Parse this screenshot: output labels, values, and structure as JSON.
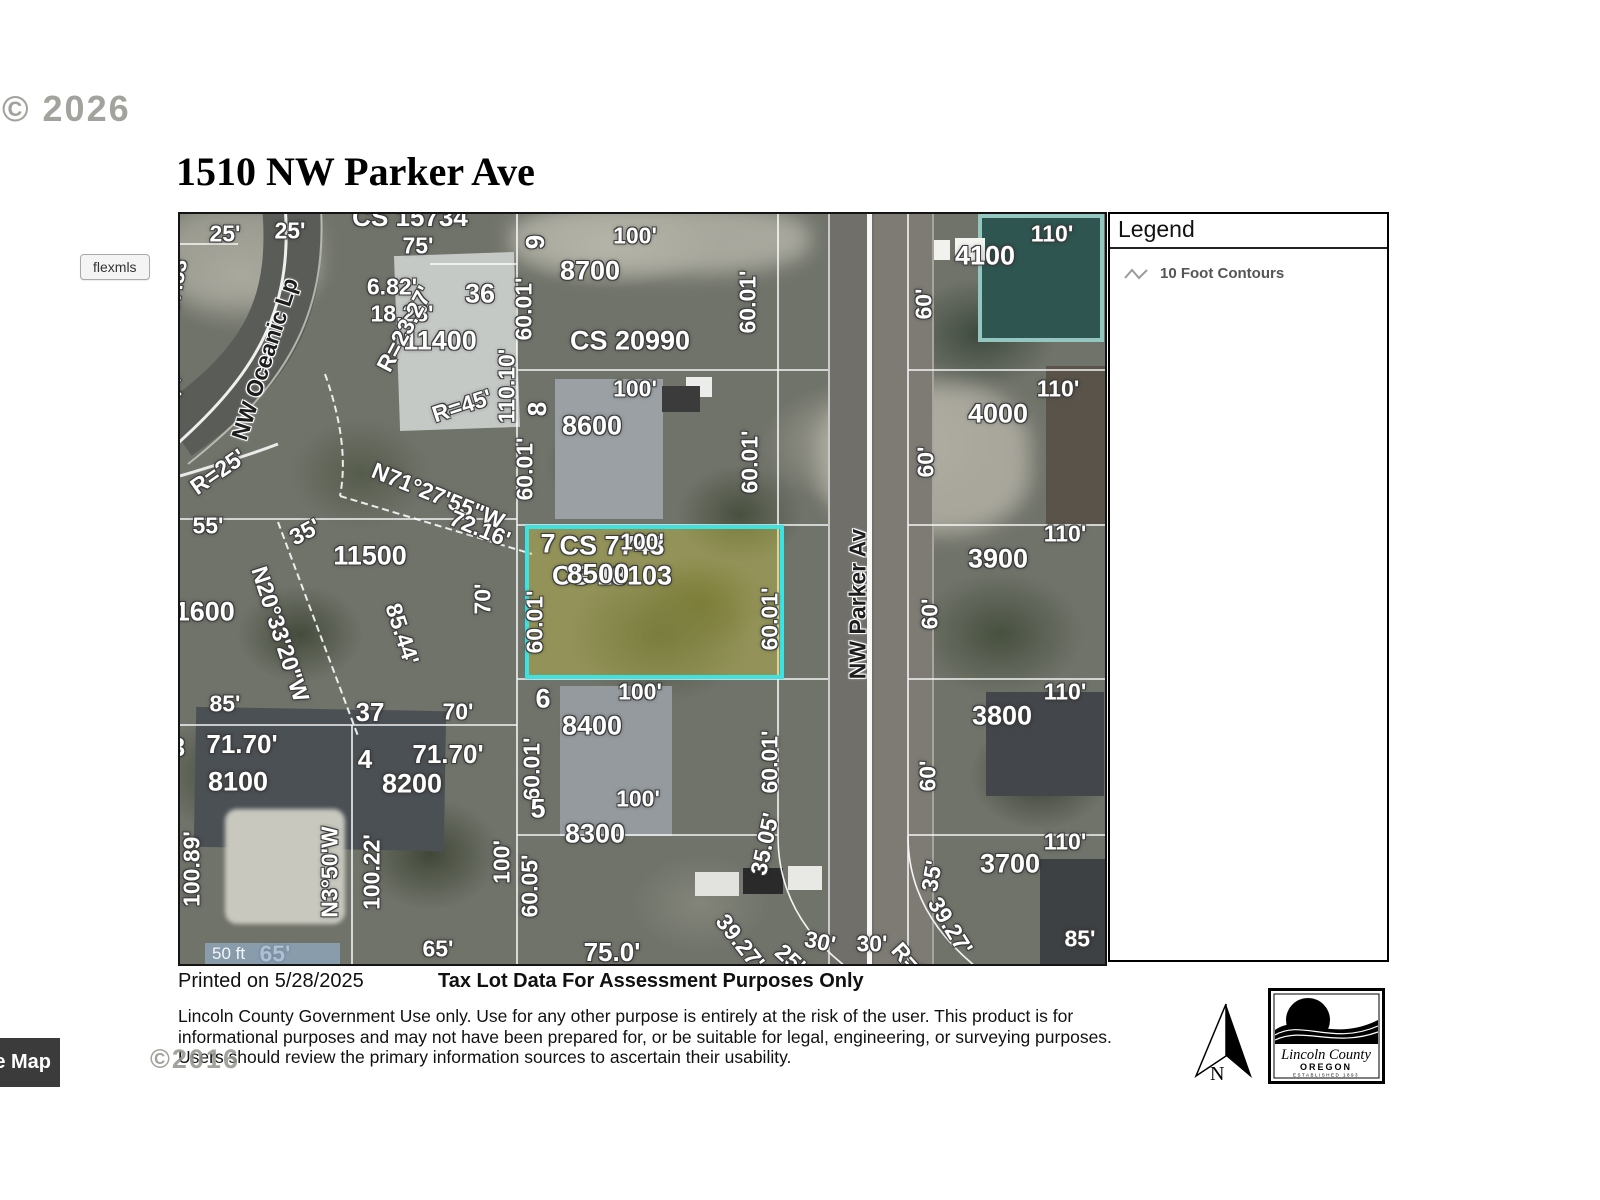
{
  "watermarks": {
    "top": "© 2026",
    "bottom": "©2016"
  },
  "header": {
    "title": "1510 NW Parker Ave"
  },
  "flexmls_button": {
    "label": "flexmls"
  },
  "legend": {
    "title": "Legend",
    "items": [
      {
        "icon": "contour-line-icon",
        "label": "10 Foot Contours"
      }
    ]
  },
  "map": {
    "scale_bar": "50 ft",
    "highlight": {
      "lot": "8500",
      "border_color": "#3be3e3",
      "fill_color": "rgba(213,206,56,0.35)"
    },
    "labels": [
      {
        "t": "25'",
        "x": 45,
        "y": 20
      },
      {
        "t": "25'",
        "x": 110,
        "y": 17
      },
      {
        "t": "CS 15734",
        "x": 230,
        "y": 3,
        "s": 26
      },
      {
        "t": "75'",
        "x": 238,
        "y": 32
      },
      {
        "t": "9",
        "x": 355,
        "y": 28,
        "r": -90,
        "s": 26
      },
      {
        "t": "100'",
        "x": 455,
        "y": 22
      },
      {
        "t": "60.01'",
        "x": 344,
        "y": 95,
        "r": -90
      },
      {
        "t": "8700",
        "x": 410,
        "y": 57,
        "s": 27
      },
      {
        "t": "60.01'",
        "x": 568,
        "y": 88,
        "r": -90
      },
      {
        "t": "110'",
        "x": 872,
        "y": 20
      },
      {
        "t": "4100",
        "x": 805,
        "y": 42,
        "s": 27
      },
      {
        "t": "60'",
        "x": 744,
        "y": 90,
        "r": -90
      },
      {
        "t": "6.82'",
        "x": 212,
        "y": 73
      },
      {
        "t": "36",
        "x": 300,
        "y": 80,
        "s": 27
      },
      {
        "t": "18.28'",
        "x": 222,
        "y": 100
      },
      {
        "t": "11400",
        "x": 260,
        "y": 127,
        "s": 27
      },
      {
        "t": "110.10'",
        "x": 327,
        "y": 172,
        "r": -90
      },
      {
        "t": "R=23.27'",
        "x": 225,
        "y": 115,
        "r": -62
      },
      {
        "t": "R=45'",
        "x": 282,
        "y": 192,
        "r": -18
      },
      {
        "t": "57.53'",
        "x": -4,
        "y": 70,
        "r": -80,
        "s": 22
      },
      {
        "t": "27'",
        "x": -6,
        "y": 178,
        "r": -48,
        "s": 22
      },
      {
        "t": "R=25'",
        "x": 38,
        "y": 258,
        "r": -35
      },
      {
        "t": "NW Oceanic Lp",
        "x": 85,
        "y": 145,
        "r": -72,
        "street": true
      },
      {
        "t": "CS 20990",
        "x": 450,
        "y": 127,
        "s": 27
      },
      {
        "t": "8",
        "x": 357,
        "y": 195,
        "r": -90,
        "s": 26
      },
      {
        "t": "100'",
        "x": 455,
        "y": 175
      },
      {
        "t": "8600",
        "x": 412,
        "y": 212,
        "s": 27
      },
      {
        "t": "60.01'",
        "x": 345,
        "y": 255,
        "r": -90
      },
      {
        "t": "60.01'",
        "x": 570,
        "y": 248,
        "r": -90
      },
      {
        "t": "110'",
        "x": 878,
        "y": 175
      },
      {
        "t": "4000",
        "x": 818,
        "y": 200,
        "s": 27
      },
      {
        "t": "60'",
        "x": 746,
        "y": 248,
        "r": -90
      },
      {
        "t": "N71°27'55\"W",
        "x": 258,
        "y": 282,
        "r": 22
      },
      {
        "t": "72.16'",
        "x": 300,
        "y": 315,
        "r": 22
      },
      {
        "t": "35'",
        "x": 125,
        "y": 318,
        "r": -28
      },
      {
        "t": "55'",
        "x": 28,
        "y": 312
      },
      {
        "t": "11600",
        "x": 18,
        "y": 398,
        "s": 27
      },
      {
        "t": "11500",
        "x": 190,
        "y": 342,
        "s": 27
      },
      {
        "t": "N20°33'20\"W",
        "x": 100,
        "y": 420,
        "r": 72
      },
      {
        "t": "85.44'",
        "x": 222,
        "y": 420,
        "r": 72
      },
      {
        "t": "CS 7743",
        "x": 432,
        "y": 332,
        "s": 27
      },
      {
        "t": "CS 18103",
        "x": 432,
        "y": 362,
        "s": 27
      },
      {
        "t": "70'",
        "x": 303,
        "y": 385,
        "r": -90
      },
      {
        "t": "7",
        "x": 368,
        "y": 330,
        "s": 27
      },
      {
        "t": "100'",
        "x": 462,
        "y": 328
      },
      {
        "t": "8500",
        "x": 418,
        "y": 360,
        "s": 28
      },
      {
        "t": "60.01'",
        "x": 355,
        "y": 408,
        "r": -90
      },
      {
        "t": "60.01'",
        "x": 590,
        "y": 405,
        "r": -90
      },
      {
        "t": "110'",
        "x": 885,
        "y": 320
      },
      {
        "t": "3900",
        "x": 818,
        "y": 345,
        "s": 27
      },
      {
        "t": "60'",
        "x": 750,
        "y": 400,
        "r": -90
      },
      {
        "t": "NW Parker Av",
        "x": 678,
        "y": 390,
        "r": -90,
        "street": true
      },
      {
        "t": "85'",
        "x": 45,
        "y": 490
      },
      {
        "t": "37",
        "x": 190,
        "y": 498,
        "s": 26
      },
      {
        "t": "70'",
        "x": 278,
        "y": 498
      },
      {
        "t": "6",
        "x": 363,
        "y": 485,
        "s": 27
      },
      {
        "t": "100'",
        "x": 460,
        "y": 478
      },
      {
        "t": "8400",
        "x": 412,
        "y": 512,
        "s": 27
      },
      {
        "t": "60.01'",
        "x": 352,
        "y": 555,
        "r": -90
      },
      {
        "t": "60.01'",
        "x": 590,
        "y": 548,
        "r": -90
      },
      {
        "t": "110'",
        "x": 885,
        "y": 478
      },
      {
        "t": "3800",
        "x": 822,
        "y": 502,
        "s": 27
      },
      {
        "t": "60'",
        "x": 748,
        "y": 562,
        "r": -90
      },
      {
        "t": "3",
        "x": -2,
        "y": 533,
        "s": 26
      },
      {
        "t": "71.70'",
        "x": 62,
        "y": 530,
        "s": 26
      },
      {
        "t": "4",
        "x": 185,
        "y": 545,
        "s": 26
      },
      {
        "t": "71.70'",
        "x": 268,
        "y": 540,
        "s": 26
      },
      {
        "t": "8100",
        "x": 58,
        "y": 568,
        "s": 27
      },
      {
        "t": "8200",
        "x": 232,
        "y": 570,
        "s": 27
      },
      {
        "t": "N3°50'W",
        "x": 150,
        "y": 658,
        "r": -90
      },
      {
        "t": "100.22'",
        "x": 192,
        "y": 658,
        "r": -90
      },
      {
        "t": "100.89'",
        "x": 12,
        "y": 655,
        "r": -90
      },
      {
        "t": "100'",
        "x": 322,
        "y": 648,
        "r": -90
      },
      {
        "t": "5",
        "x": 358,
        "y": 595,
        "s": 27
      },
      {
        "t": "100'",
        "x": 458,
        "y": 585
      },
      {
        "t": "8300",
        "x": 415,
        "y": 620,
        "s": 27
      },
      {
        "t": "60.05'",
        "x": 350,
        "y": 672,
        "r": -90
      },
      {
        "t": "35.05'",
        "x": 585,
        "y": 630,
        "r": -78
      },
      {
        "t": "110'",
        "x": 885,
        "y": 628
      },
      {
        "t": "3700",
        "x": 830,
        "y": 650,
        "s": 27
      },
      {
        "t": "35'",
        "x": 752,
        "y": 662,
        "r": -80
      },
      {
        "t": "75.0'",
        "x": 432,
        "y": 738,
        "s": 26
      },
      {
        "t": "39.27'",
        "x": 560,
        "y": 728,
        "r": 52
      },
      {
        "t": "25'",
        "x": 610,
        "y": 745,
        "r": 42
      },
      {
        "t": "30'",
        "x": 640,
        "y": 728,
        "r": 12
      },
      {
        "t": "30'",
        "x": 692,
        "y": 730
      },
      {
        "t": "R=2",
        "x": 730,
        "y": 748,
        "r": 48
      },
      {
        "t": "39.27'",
        "x": 770,
        "y": 712,
        "r": 58
      },
      {
        "t": "85'",
        "x": 900,
        "y": 725
      },
      {
        "t": "65'",
        "x": 95,
        "y": 740
      },
      {
        "t": "65'",
        "x": 258,
        "y": 735
      }
    ]
  },
  "footer": {
    "printed_on": "Printed on 5/28/2025",
    "assessment_notice": "Tax Lot Data For Assessment Purposes Only",
    "disclaimer": "Lincoln County Government Use only. Use for any other purpose is entirely at the risk of the user. This product is for informational purposes and may not have been prepared for, or be suitable for legal, engineering, or surveying purposes. Users should review the primary information sources to ascertain their usability.",
    "map_button": "e Map",
    "north_label": "N",
    "logo": {
      "line1": "Lincoln County",
      "line2": "OREGON",
      "line3": "ESTABLISHED 1893"
    }
  }
}
